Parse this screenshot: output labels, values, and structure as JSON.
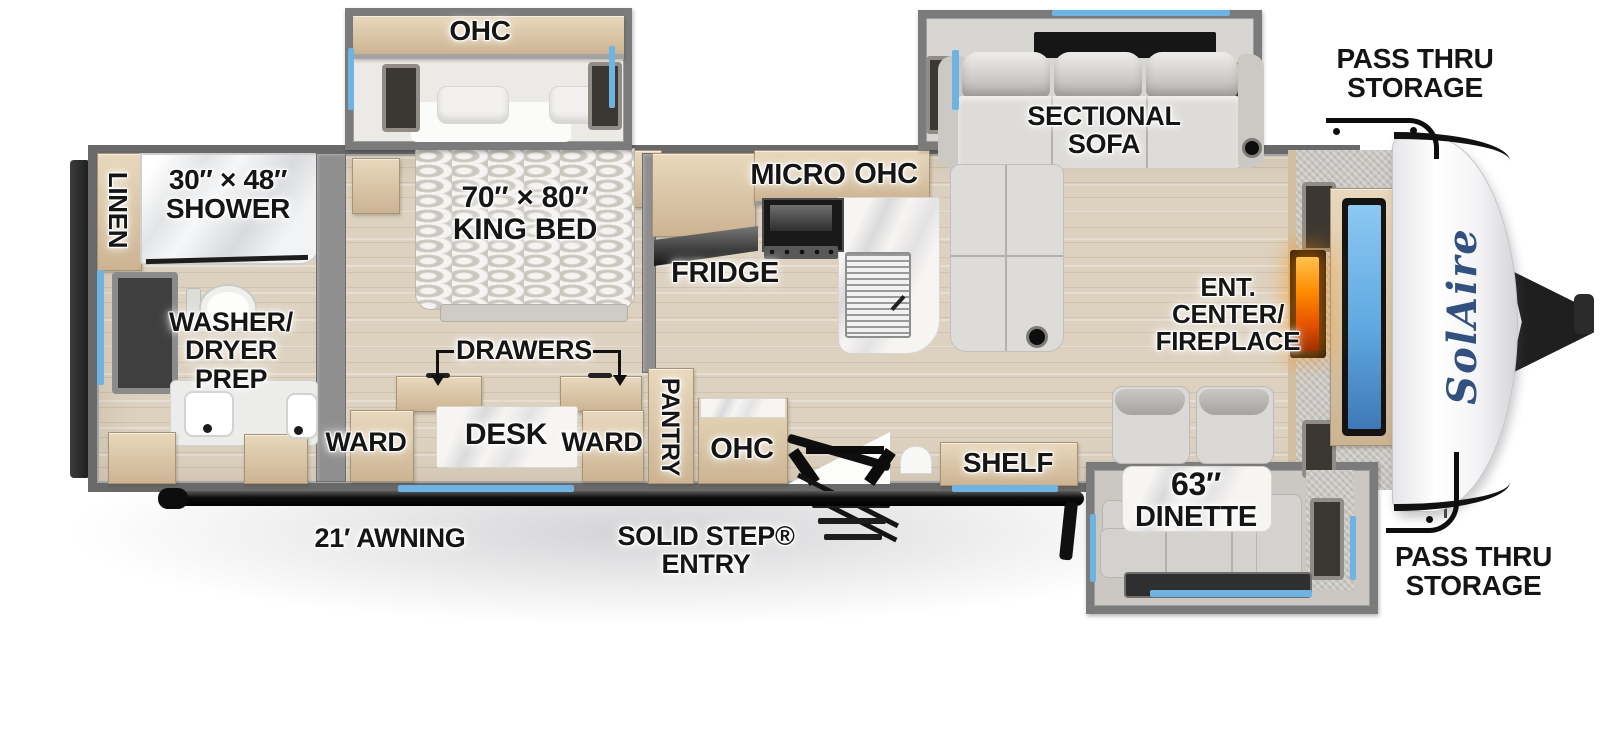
{
  "title": "SolAire travel trailer floorplan diagram",
  "brand": {
    "logo_text": "SolAire"
  },
  "colors": {
    "window_accent_blue": "#6fb3e2",
    "floor_wood": "#ddd2c0",
    "cabinet_tan": "#d9c6a9",
    "wall_gray": "#7b7b7b",
    "fireplace_orange": "#ff8a00",
    "tv_screen_blue": "#5fa8e0",
    "logo_blue": "#32517e",
    "label_text": "#151515",
    "awning_black": "#111111"
  },
  "labels": {
    "bedroom_ohc": "OHC",
    "king_bed_size": "70″ × 80″",
    "king_bed_name": "KING BED",
    "drawers": "DRAWERS",
    "desk": "DESK",
    "ward_left": "WARD",
    "ward_right": "WARD",
    "pantry": "PANTRY",
    "linen": "LINEN",
    "shower_size": "30″ × 48″",
    "shower_name": "SHOWER",
    "washer_line1": "WASHER/",
    "washer_line2": "DRYER PREP",
    "fridge": "FRIDGE",
    "micro": "MICRO",
    "kitchen_ohc": "OHC",
    "entry_ohc": "OHC",
    "shelf": "SHELF",
    "sectional_sofa": "SECTIONAL SOFA",
    "ent_line1": "ENT.",
    "ent_line2": "CENTER/",
    "ent_line3": "FIREPLACE",
    "dinette_size": "63″",
    "dinette_name": "DINETTE",
    "pass_thru_top_line1": "PASS THRU",
    "pass_thru_top_line2": "STORAGE",
    "pass_thru_bottom_line1": "PASS THRU",
    "pass_thru_bottom_line2": "STORAGE",
    "awning": "21′ AWNING",
    "entry_line1": "SOLID STEP®",
    "entry_line2": "ENTRY"
  }
}
